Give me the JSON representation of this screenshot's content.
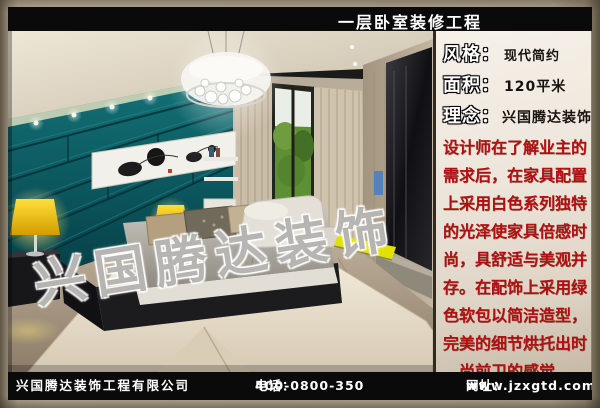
{
  "header": {
    "title": "一层卧室装修工程"
  },
  "info_panel": {
    "fields": [
      {
        "label": "风格：",
        "value": "现代简约"
      },
      {
        "label": "面积：",
        "value": "120平米"
      },
      {
        "label": "理念：",
        "value": "兴国腾达装饰"
      }
    ],
    "description": "设计师在了解业主的需求后，在家具配置上采用白色系列独特的光泽使家具倍感时尚，具舒适与美观并存。在配饰上采用绿色软包以简洁造型，完美的细节烘托出时尚前卫的感觉。"
  },
  "photo": {
    "watermark": "兴国腾达装饰"
  },
  "footer": {
    "company": "兴国腾达装饰工程有限公司",
    "phone_label": "电话：",
    "phone_number": "400-0800-350",
    "website_label": "网址：",
    "website": "www.jzxgtd.com"
  },
  "colors": {
    "bar_background": "#0a0a0a",
    "bar_text": "#ffffff",
    "frame_background": "#b5aa94",
    "panel_background": "#efe9df",
    "description_text": "#b01010",
    "accent_teal": "#0c5a60",
    "accent_yellow": "#f0c800"
  }
}
